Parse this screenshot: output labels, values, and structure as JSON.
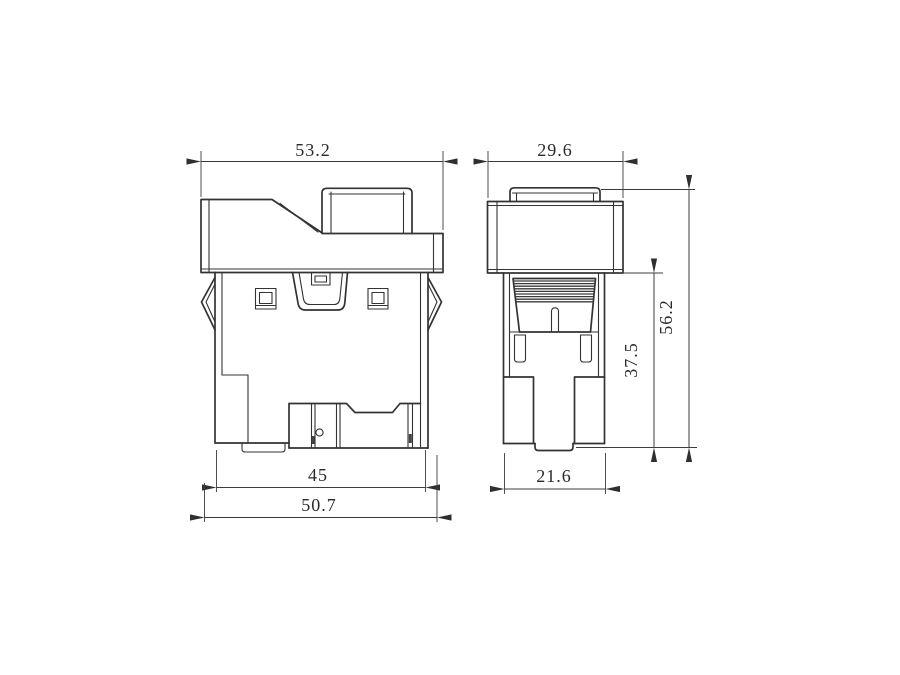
{
  "drawing": {
    "kind": "technical-dimension-drawing",
    "views": {
      "front_view": "rocker switch, front elevation",
      "side_view": "rocker switch, side elevation"
    },
    "colors": {
      "background": "#ffffff",
      "line": "#333333",
      "serration": "#3a3a3a"
    },
    "dimensions": {
      "front_overall_width": "53.2",
      "side_width": "29.6",
      "front_body_width": "45",
      "front_flange_width": "50.7",
      "side_body_width": "21.6",
      "body_height": "37.5",
      "total_height": "56.2"
    }
  }
}
